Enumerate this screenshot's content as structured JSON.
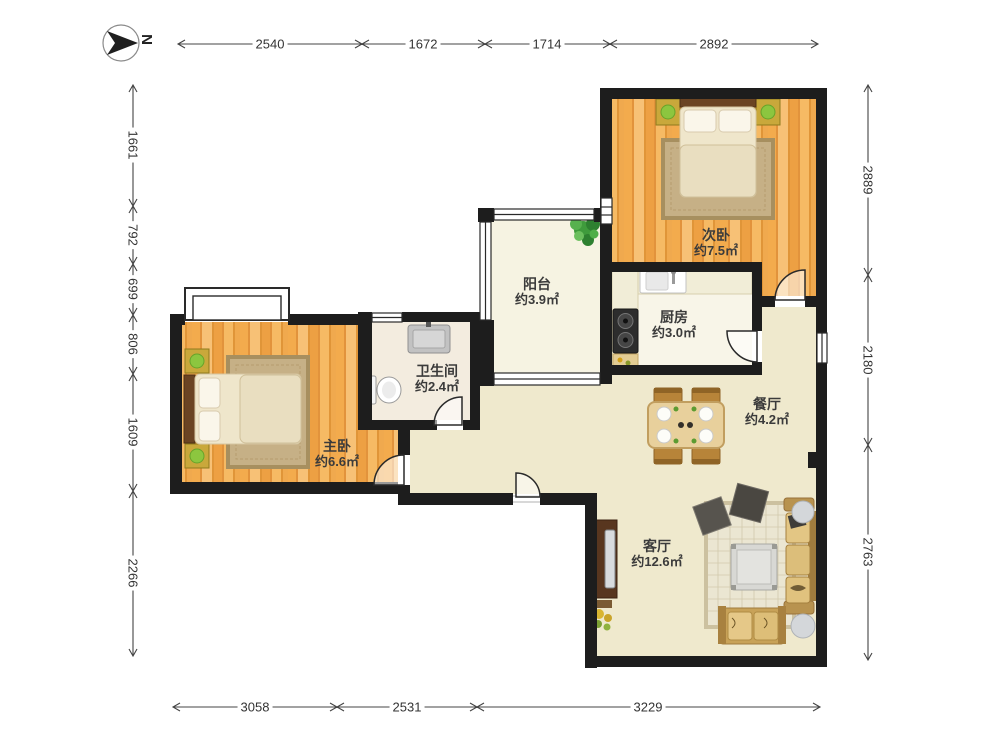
{
  "compass": {
    "north_label": "N"
  },
  "rooms": [
    {
      "id": "secondary-bedroom",
      "name": "次卧",
      "area": "约7.5㎡"
    },
    {
      "id": "balcony",
      "name": "阳台",
      "area": "约3.9㎡"
    },
    {
      "id": "kitchen",
      "name": "厨房",
      "area": "约3.0㎡"
    },
    {
      "id": "dining-room",
      "name": "餐厅",
      "area": "约4.2㎡"
    },
    {
      "id": "bathroom",
      "name": "卫生间",
      "area": "约2.4㎡"
    },
    {
      "id": "master-bedroom",
      "name": "主卧",
      "area": "约6.6㎡"
    },
    {
      "id": "living-room",
      "name": "客厅",
      "area": "约12.6㎡"
    }
  ],
  "dimensions": {
    "top": [
      "2540",
      "1672",
      "1714",
      "2892"
    ],
    "left": [
      "1661",
      "792",
      "699",
      "806",
      "1609",
      "2266"
    ],
    "right": [
      "2889",
      "2180",
      "2763"
    ],
    "bottom": [
      "3058",
      "2531",
      "3229"
    ]
  },
  "colors": {
    "wall": "#1d1d1d",
    "wood_floor": "#f3ab4d",
    "open_floor": "#efe9cd",
    "balcony_floor": "#f6f3e2",
    "kitchen_floor": "#f8f5e8",
    "bathroom_floor": "#f3ecdf"
  }
}
